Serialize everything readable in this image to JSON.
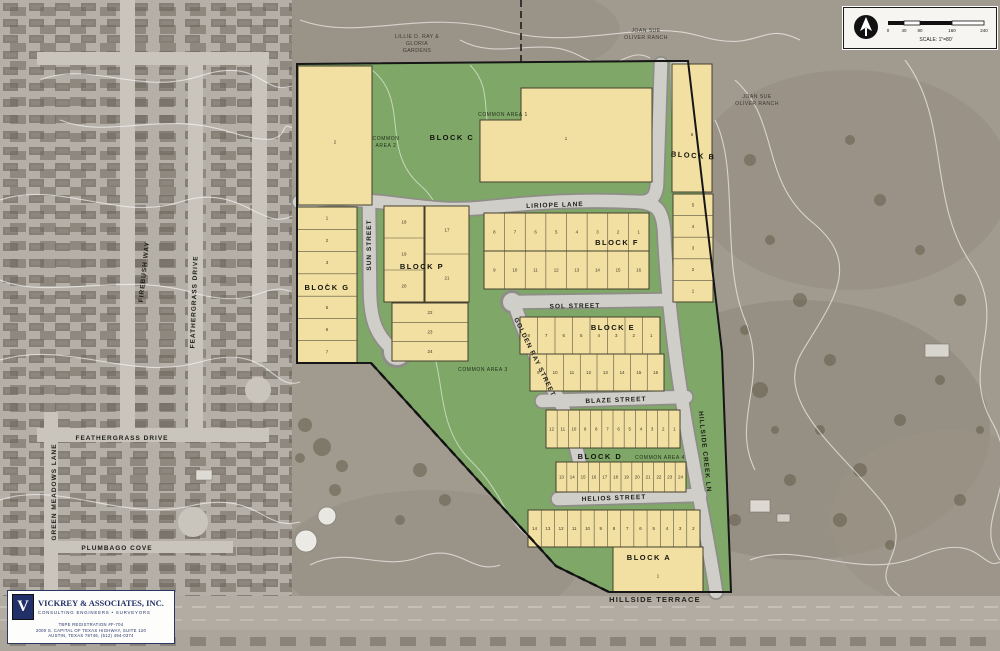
{
  "streets": {
    "liriope": "LIRIOPE LANE",
    "sun": "SUN STREET",
    "sol": "SOL STREET",
    "golden_ray": "GOLDEN RAY STREET",
    "blaze": "BLAZE STREET",
    "helios": "HELIOS STREET",
    "hillside_creek": "HILLSIDE CREEK LN",
    "hillside_terrace": "HILLSIDE TERRACE",
    "feathergrass_v": "FEATHERGRASS DRIVE",
    "feathergrass_h": "FEATHERGRASS DRIVE",
    "firebush": "FIREBUSH WAY",
    "green_meadows": "GREEN MEADOWS LANE",
    "plumbago": "PLUMBAGO COVE"
  },
  "blocks": {
    "a": {
      "label": "BLOCK A",
      "lot": "1"
    },
    "b": {
      "label": "BLOCK B",
      "big_lot": "6",
      "lots": [
        "5",
        "4",
        "3",
        "2",
        "1"
      ]
    },
    "c": {
      "label": "BLOCK C",
      "lot1": "1",
      "lot2": "2"
    },
    "d": {
      "label": "BLOCK D",
      "row1": [
        "12",
        "11",
        "10",
        "9",
        "8",
        "7",
        "6",
        "5",
        "4",
        "3",
        "2",
        "1"
      ],
      "row2": [
        "13",
        "14",
        "15",
        "16",
        "17",
        "18",
        "19",
        "20",
        "21",
        "22",
        "23",
        "24"
      ]
    },
    "e": {
      "label": "BLOCK E",
      "row1": [
        "8",
        "7",
        "6",
        "5",
        "4",
        "3",
        "2",
        "1"
      ],
      "row2": [
        "9",
        "10",
        "11",
        "12",
        "13",
        "14",
        "15",
        "16"
      ]
    },
    "f": {
      "label": "BLOCK F",
      "row1": [
        "8",
        "7",
        "6",
        "5",
        "4",
        "3",
        "2",
        "1"
      ],
      "row2": [
        "9",
        "10",
        "11",
        "12",
        "13",
        "14",
        "15",
        "16"
      ]
    },
    "g": {
      "label": "BLOCK G",
      "lots": [
        "1",
        "2",
        "3",
        "4",
        "5",
        "6",
        "7"
      ]
    },
    "p": {
      "label": "BLOCK P",
      "col1": [
        "18",
        "19",
        "20"
      ],
      "col2": [
        "17",
        "21"
      ],
      "col3": [
        "22",
        "23",
        "24"
      ]
    }
  },
  "bottom_row": {
    "lots": [
      "14",
      "13",
      "12",
      "11",
      "10",
      "9",
      "8",
      "7",
      "6",
      "5",
      "4",
      "3",
      "2"
    ]
  },
  "common_areas": {
    "ca1": "COMMON AREA 1",
    "ca2a": "COMMON",
    "ca2b": "AREA 2",
    "ca3": "COMMON AREA 3",
    "ca4": "COMMON AREA 4"
  },
  "adjacent": {
    "nw": [
      "LILLIE D. RAY &",
      "GLORIA",
      "GARDENS"
    ],
    "ne": [
      "JOAN SUE",
      "OLIVER RANCH"
    ],
    "e": [
      "JOAN SUE",
      "OLIVER RANCH"
    ]
  },
  "scale": {
    "label": "SCALE: 1\"=80'",
    "t0": "0",
    "t1": "40",
    "t2": "80",
    "t3": "160",
    "t4": "240"
  },
  "firm": {
    "logo_letter": "V",
    "name": "VICKREY & ASSOCIATES, INC.",
    "tagline": "CONSULTING ENGINEERS • SURVEYORS",
    "line1": "TBPE REGISTRATION #F-704",
    "line2": "2000 S. CAPITAL OF TEXAS HIGHWAY, SUITE 120",
    "line3": "AUSTIN, TEXAS 78746, (512) 494-0374"
  },
  "colors": {
    "lot_yellow": "#f2dfa2",
    "open_green": "#7fa767",
    "street_gray": "#cfcec9",
    "aerial_gray": "#a49e94"
  }
}
